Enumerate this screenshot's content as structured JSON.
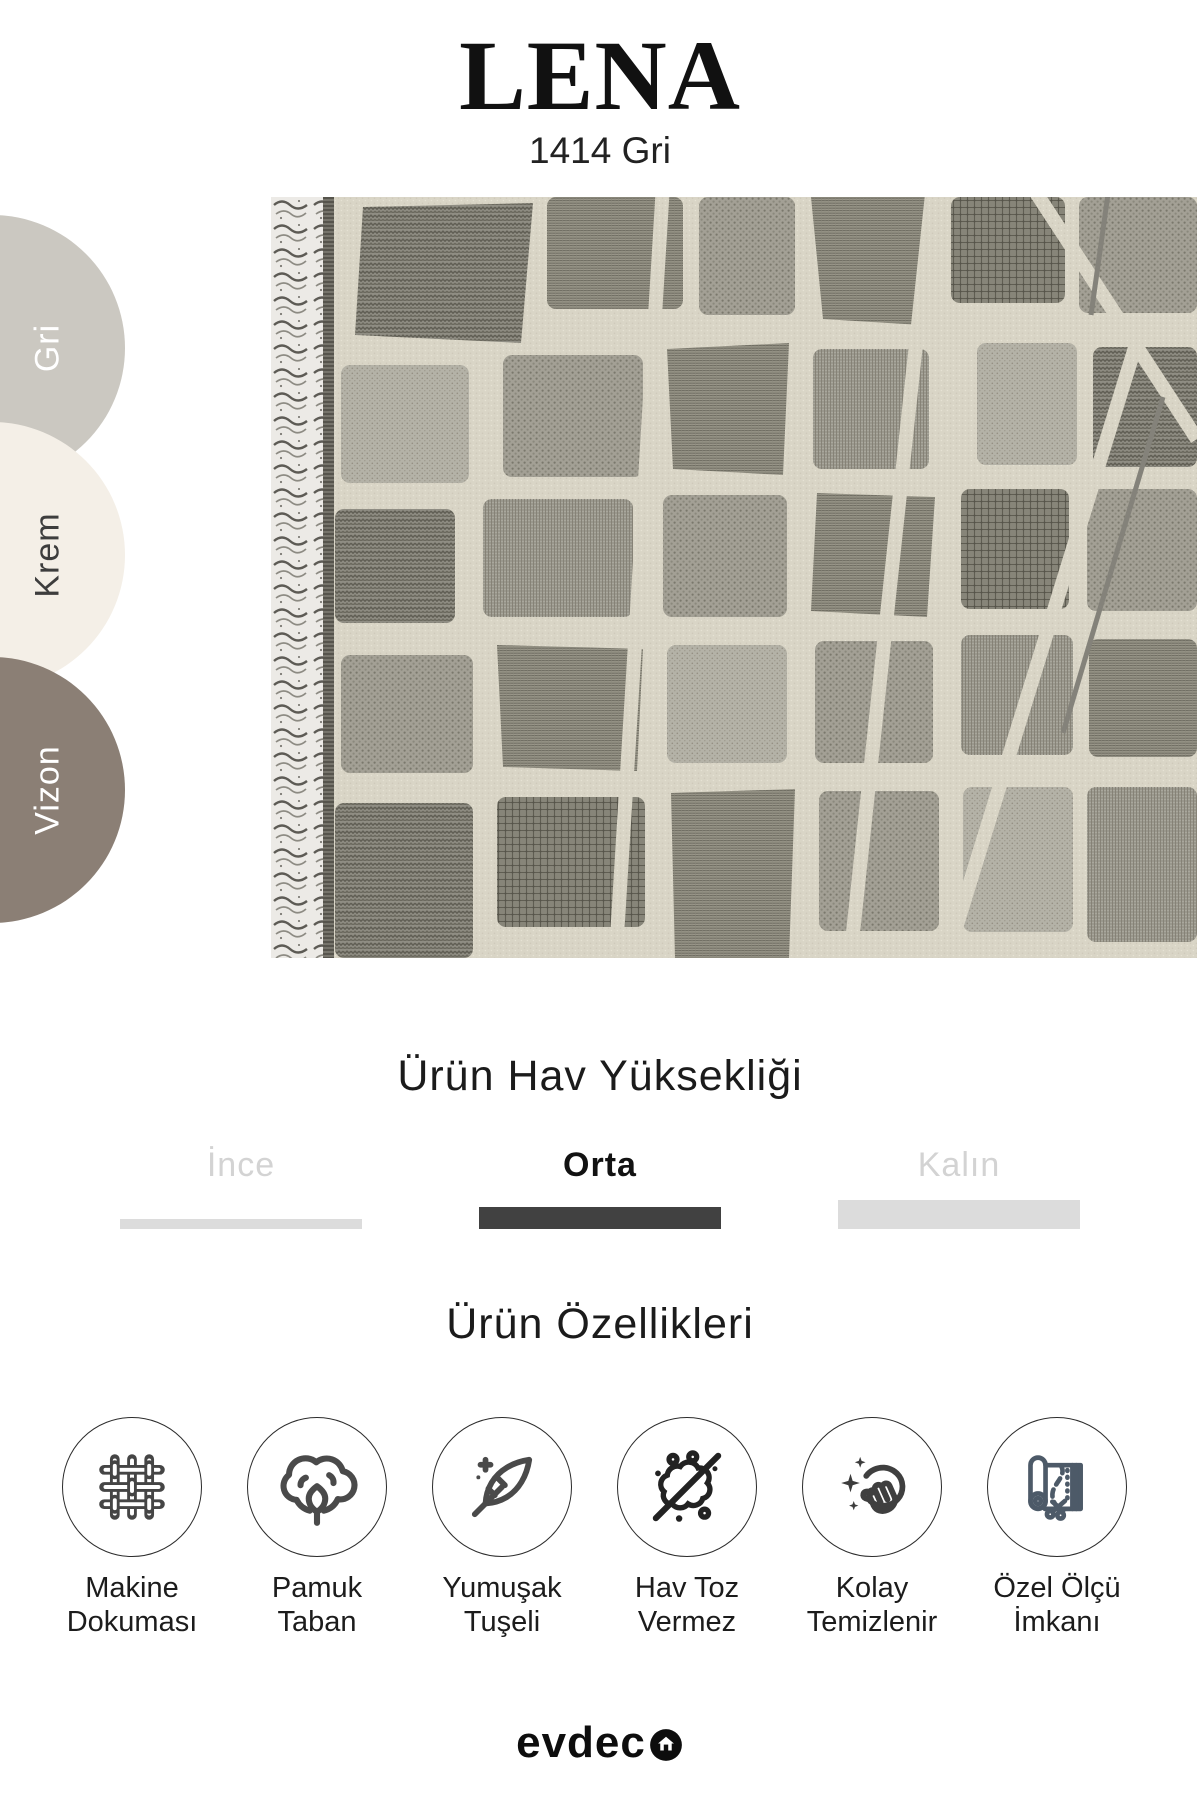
{
  "title": "LENA",
  "subtitle": "1414 Gri",
  "swatches": [
    {
      "label": "Gri",
      "hex": "#cbc8c1",
      "label_color": "#ffffff"
    },
    {
      "label": "Krem",
      "hex": "#f4efe7",
      "label_color": "#3d3d3d"
    },
    {
      "label": "Vizon",
      "hex": "#8b7f75",
      "label_color": "#ffffff"
    }
  ],
  "rug_photo": {
    "base_color": "#d9d5c6",
    "block_color": "#97948a",
    "fringe_color": "#5d5b55"
  },
  "pile_height": {
    "heading": "Ürün Hav Yüksekliği",
    "options": [
      {
        "label": "İnce",
        "selected": false
      },
      {
        "label": "Orta",
        "selected": true
      },
      {
        "label": "Kalın",
        "selected": false
      }
    ],
    "selected_bar_color": "#414141",
    "unselected_bar_color": "#dcdcdc"
  },
  "features": {
    "heading": "Ürün Özellikleri",
    "items": [
      {
        "icon": "woven-fabric-icon",
        "lines": [
          "Makine",
          "Dokuması"
        ]
      },
      {
        "icon": "cotton-icon",
        "lines": [
          "Pamuk",
          "Taban"
        ]
      },
      {
        "icon": "feather-icon",
        "lines": [
          "Yumuşak",
          "Tuşeli"
        ]
      },
      {
        "icon": "no-dust-icon",
        "lines": [
          "Hav Toz",
          "Vermez"
        ]
      },
      {
        "icon": "easy-clean-icon",
        "lines": [
          "Kolay",
          "Temizlenir"
        ]
      },
      {
        "icon": "custom-size-icon",
        "lines": [
          "Özel Ölçü",
          "İmkanı"
        ]
      }
    ]
  },
  "footer": {
    "brand": "evdeco",
    "logo_text": "evdec"
  }
}
